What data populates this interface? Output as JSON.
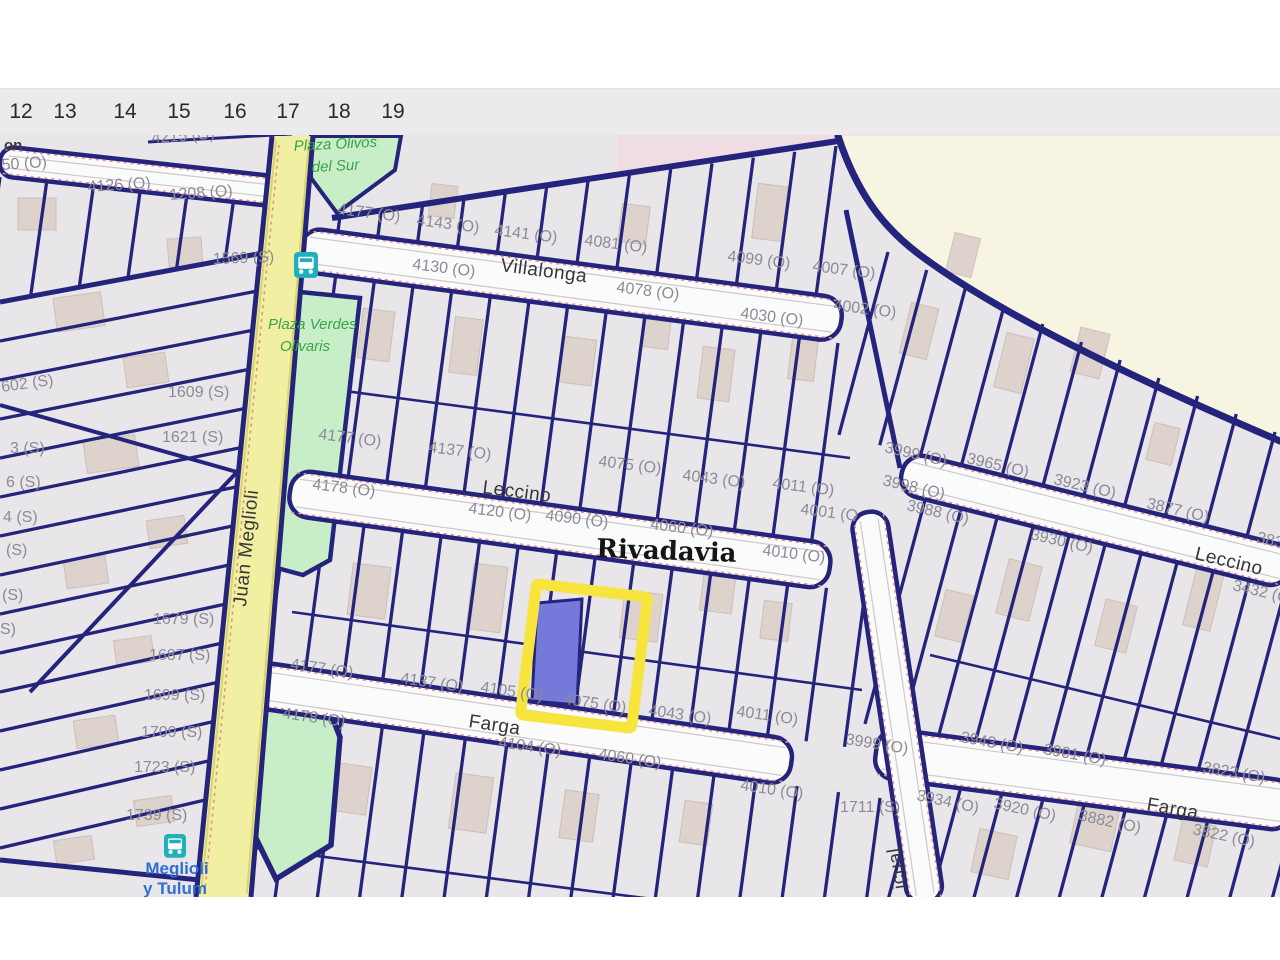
{
  "ruler": {
    "items": [
      {
        "t": "12",
        "x": 21
      },
      {
        "t": "13",
        "x": 65
      },
      {
        "t": "14",
        "x": 125
      },
      {
        "t": "15",
        "x": 179
      },
      {
        "t": "16",
        "x": 235
      },
      {
        "t": "17",
        "x": 288
      },
      {
        "t": "18",
        "x": 339
      },
      {
        "t": "19",
        "x": 393
      }
    ]
  },
  "map": {
    "locality": "Rivadavia",
    "colors": {
      "parcel_line_navy": "#24247c",
      "block_gray": "#e8e6e8",
      "street_white": "#fcfbfc",
      "open_area_cream": "#f7f4e1",
      "residential_pink": "#f0dde3",
      "plaza_green": "#c7eec6",
      "main_street_yellow": "#f1f0a2",
      "selection_highlight": "#f7e43c",
      "selected_parcel_blue": "#7479da",
      "bus_teal": "#21b0bb"
    },
    "selected_parcel": {
      "status": "highlighted"
    },
    "bus_stops": [
      {
        "name": "bus-stop-top"
      },
      {
        "name": "bus-stop-meglioli-y-tulum"
      }
    ],
    "labels": [
      {
        "t": "4215 (O)",
        "x": 152,
        "y": 143,
        "r": -4,
        "k": "n"
      },
      {
        "t": "on",
        "x": 4,
        "y": 150,
        "r": 0,
        "k": "f"
      },
      {
        "t": "50 (O)",
        "x": 2,
        "y": 170,
        "r": -4,
        "k": "n"
      },
      {
        "t": "4126 (O)",
        "x": 88,
        "y": 192,
        "r": -4,
        "k": "n"
      },
      {
        "t": "1208 (O)",
        "x": 170,
        "y": 200,
        "r": -4,
        "k": "n"
      },
      {
        "t": "1569 (S)",
        "x": 213,
        "y": 264,
        "r": -2,
        "k": "n"
      },
      {
        "t": "602 (S)",
        "x": 2,
        "y": 392,
        "r": -8,
        "k": "n"
      },
      {
        "t": "1609 (S)",
        "x": 168,
        "y": 397,
        "r": 0,
        "k": "n"
      },
      {
        "t": "1621 (S)",
        "x": 162,
        "y": 442,
        "r": 0,
        "k": "n"
      },
      {
        "t": "3 (S)",
        "x": 10,
        "y": 453,
        "r": 0,
        "k": "n"
      },
      {
        "t": "6 (S)",
        "x": 6,
        "y": 487,
        "r": 0,
        "k": "n"
      },
      {
        "t": "4 (S)",
        "x": 3,
        "y": 522,
        "r": 0,
        "k": "n"
      },
      {
        "t": "(S)",
        "x": 6,
        "y": 555,
        "r": 0,
        "k": "n"
      },
      {
        "t": "(S)",
        "x": 2,
        "y": 600,
        "r": 0,
        "k": "n"
      },
      {
        "t": "S)",
        "x": 0,
        "y": 634,
        "r": 0,
        "k": "n"
      },
      {
        "t": "1679 (S)",
        "x": 153,
        "y": 624,
        "r": 0,
        "k": "n"
      },
      {
        "t": "1687 (S)",
        "x": 149,
        "y": 660,
        "r": 0,
        "k": "n"
      },
      {
        "t": "1699 (S)",
        "x": 144,
        "y": 700,
        "r": 0,
        "k": "n"
      },
      {
        "t": "1709 (S)",
        "x": 141,
        "y": 737,
        "r": 0,
        "k": "n"
      },
      {
        "t": "1723 (S)",
        "x": 134,
        "y": 772,
        "r": 0,
        "k": "n"
      },
      {
        "t": "1739 (S)",
        "x": 126,
        "y": 820,
        "r": 0,
        "k": "n"
      },
      {
        "t": "4177 (O)",
        "x": 337,
        "y": 214,
        "r": 7,
        "k": "n"
      },
      {
        "t": "4143 (O)",
        "x": 416,
        "y": 225,
        "r": 7,
        "k": "n"
      },
      {
        "t": "4141 (O)",
        "x": 494,
        "y": 235,
        "r": 7,
        "k": "n"
      },
      {
        "t": "4081 (O)",
        "x": 584,
        "y": 245,
        "r": 7,
        "k": "n"
      },
      {
        "t": "4099 (O)",
        "x": 727,
        "y": 261,
        "r": 7,
        "k": "n"
      },
      {
        "t": "4007 (O)",
        "x": 812,
        "y": 271,
        "r": 7,
        "k": "n"
      },
      {
        "t": "4130 (O)",
        "x": 412,
        "y": 269,
        "r": 7,
        "k": "n"
      },
      {
        "t": "4078 (O)",
        "x": 616,
        "y": 292,
        "r": 7,
        "k": "n"
      },
      {
        "t": "4030 (O)",
        "x": 740,
        "y": 318,
        "r": 7,
        "k": "n"
      },
      {
        "t": "4002 (O)",
        "x": 833,
        "y": 310,
        "r": 7,
        "k": "n"
      },
      {
        "t": "4177 (O)",
        "x": 318,
        "y": 439,
        "r": 7,
        "k": "n"
      },
      {
        "t": "4137 (O)",
        "x": 428,
        "y": 452,
        "r": 7,
        "k": "n"
      },
      {
        "t": "4075 (O)",
        "x": 598,
        "y": 466,
        "r": 7,
        "k": "n"
      },
      {
        "t": "4043 (O)",
        "x": 682,
        "y": 480,
        "r": 7,
        "k": "n"
      },
      {
        "t": "4011 (O)",
        "x": 772,
        "y": 488,
        "r": 7,
        "k": "n"
      },
      {
        "t": "4001 (O",
        "x": 800,
        "y": 514,
        "r": 7,
        "k": "n"
      },
      {
        "t": "4178 (O)",
        "x": 312,
        "y": 489,
        "r": 7,
        "k": "n"
      },
      {
        "t": "4120 (O)",
        "x": 468,
        "y": 513,
        "r": 7,
        "k": "n"
      },
      {
        "t": "4090 (O)",
        "x": 545,
        "y": 520,
        "r": 7,
        "k": "n"
      },
      {
        "t": "4060 (O)",
        "x": 650,
        "y": 529,
        "r": 7,
        "k": "n"
      },
      {
        "t": "4010 (O)",
        "x": 762,
        "y": 555,
        "r": 7,
        "k": "n"
      },
      {
        "t": "4177 (O)",
        "x": 290,
        "y": 669,
        "r": 8,
        "k": "n"
      },
      {
        "t": "4137 (O)",
        "x": 400,
        "y": 683,
        "r": 8,
        "k": "n"
      },
      {
        "t": "4105 (O)",
        "x": 480,
        "y": 692,
        "r": 8,
        "k": "n"
      },
      {
        "t": "4075 (O)",
        "x": 563,
        "y": 704,
        "r": 8,
        "k": "n"
      },
      {
        "t": "4043 (O)",
        "x": 648,
        "y": 715,
        "r": 8,
        "k": "n"
      },
      {
        "t": "4011 (O)",
        "x": 736,
        "y": 716,
        "r": 8,
        "k": "n"
      },
      {
        "t": "4178 (O)",
        "x": 282,
        "y": 718,
        "r": 8,
        "k": "n"
      },
      {
        "t": "4104 (O)",
        "x": 498,
        "y": 747,
        "r": 8,
        "k": "n"
      },
      {
        "t": "4060 (O)",
        "x": 598,
        "y": 759,
        "r": 8,
        "k": "n"
      },
      {
        "t": "4010 (O)",
        "x": 740,
        "y": 790,
        "r": 8,
        "k": "n"
      },
      {
        "t": "1711 (S)",
        "x": 840,
        "y": 812,
        "r": 0,
        "k": "n"
      },
      {
        "t": "3999 (O)",
        "x": 845,
        "y": 744,
        "r": 9,
        "k": "n"
      },
      {
        "t": "3999 (O)",
        "x": 884,
        "y": 452,
        "r": 13,
        "k": "n"
      },
      {
        "t": "3965 (O)",
        "x": 966,
        "y": 463,
        "r": 13,
        "k": "n"
      },
      {
        "t": "3998 (O)",
        "x": 882,
        "y": 485,
        "r": 13,
        "k": "n"
      },
      {
        "t": "3988 (O)",
        "x": 906,
        "y": 510,
        "r": 13,
        "k": "n"
      },
      {
        "t": "3923 (O)",
        "x": 1053,
        "y": 484,
        "r": 13,
        "k": "n"
      },
      {
        "t": "3877 (O)",
        "x": 1146,
        "y": 508,
        "r": 13,
        "k": "n"
      },
      {
        "t": "3930 (O)",
        "x": 1030,
        "y": 539,
        "r": 13,
        "k": "n"
      },
      {
        "t": "3837 (O)",
        "x": 1256,
        "y": 542,
        "r": 13,
        "k": "n"
      },
      {
        "t": "3432 (O)",
        "x": 1232,
        "y": 590,
        "r": 13,
        "k": "n"
      },
      {
        "t": "3943 (O)",
        "x": 960,
        "y": 742,
        "r": 10,
        "k": "n"
      },
      {
        "t": "3901 (O)",
        "x": 1043,
        "y": 754,
        "r": 10,
        "k": "n"
      },
      {
        "t": "3823 (O)",
        "x": 1202,
        "y": 772,
        "r": 10,
        "k": "n"
      },
      {
        "t": "3934 (O)",
        "x": 916,
        "y": 800,
        "r": 12,
        "k": "n"
      },
      {
        "t": "3920 (O)",
        "x": 993,
        "y": 808,
        "r": 12,
        "k": "n"
      },
      {
        "t": "3882 (O)",
        "x": 1078,
        "y": 820,
        "r": 12,
        "k": "n"
      },
      {
        "t": "3822 (O)",
        "x": 1192,
        "y": 834,
        "r": 12,
        "k": "n"
      },
      {
        "t": "Villalonga",
        "x": 500,
        "y": 271,
        "r": 7.5,
        "k": "s"
      },
      {
        "t": "Leccino",
        "x": 482,
        "y": 493,
        "r": 7.5,
        "k": "s"
      },
      {
        "t": "Farga",
        "x": 468,
        "y": 727,
        "r": 8.5,
        "k": "s"
      },
      {
        "t": "Leccino",
        "x": 1194,
        "y": 559,
        "r": 13.5,
        "k": "s"
      },
      {
        "t": "Farga",
        "x": 1146,
        "y": 810,
        "r": 10,
        "k": "s"
      },
      {
        "t": "Juan Meglioli",
        "x": 246,
        "y": 607,
        "r": -84,
        "k": "s"
      },
      {
        "t": "icual",
        "x": 906,
        "y": 888,
        "r": -99,
        "k": "s"
      },
      {
        "t": "Plaza Olivos",
        "x": 294,
        "y": 151,
        "r": -3,
        "k": "p"
      },
      {
        "t": "del Sur",
        "x": 312,
        "y": 172,
        "r": -3,
        "k": "p"
      },
      {
        "t": "Plaza Verdes",
        "x": 268,
        "y": 329,
        "r": 0,
        "k": "p"
      },
      {
        "t": "Olivaris",
        "x": 280,
        "y": 351,
        "r": 0,
        "k": "p"
      },
      {
        "t": "Rivadavia",
        "x": 596,
        "y": 557,
        "r": 2,
        "k": "l"
      },
      {
        "t": "Meglioli",
        "x": 177,
        "y": 874,
        "r": 0,
        "k": "b"
      },
      {
        "t": "y Tulum",
        "x": 175,
        "y": 894,
        "r": 0,
        "k": "b"
      }
    ]
  }
}
